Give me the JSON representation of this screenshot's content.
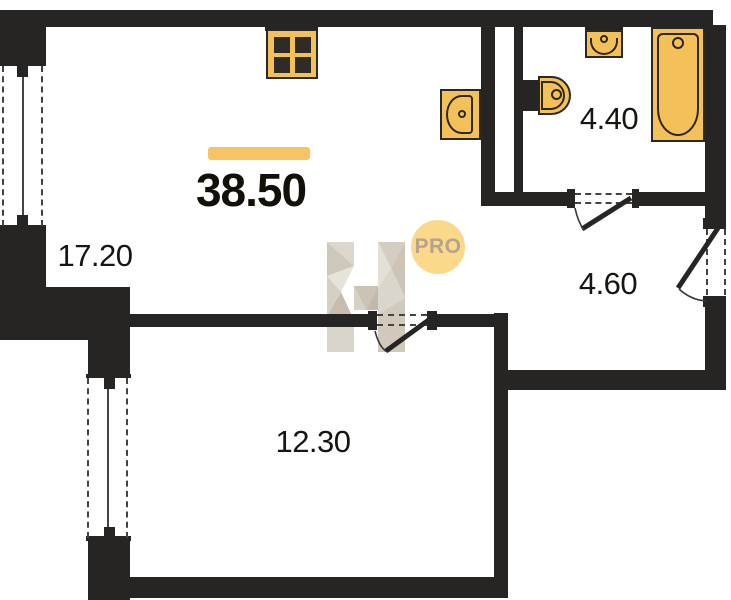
{
  "total": {
    "area": "38.50"
  },
  "rooms": {
    "living": {
      "area": "17.20"
    },
    "bedroom": {
      "area": "12.30"
    },
    "bathroom": {
      "area": "4.40"
    },
    "hallway": {
      "area": "4.60"
    }
  },
  "watermark": {
    "badge_text": "PRO",
    "logo": "H-logo"
  },
  "icons": {
    "stove": "stove-icon",
    "kitchen_sink": "sink-icon",
    "toilet": "toilet-icon",
    "washbasin": "washbasin-icon",
    "bathtub": "bathtub-icon"
  },
  "windows": [
    {
      "id": "living-room-window"
    },
    {
      "id": "bedroom-window"
    }
  ],
  "doors": [
    {
      "id": "bedroom-door"
    },
    {
      "id": "bathroom-door"
    },
    {
      "id": "entrance-door"
    }
  ],
  "colors": {
    "wall": "#272523",
    "fixture_fill": "#f3c158",
    "fixture_stroke": "#2b2722",
    "area_bar": "#f6c464",
    "badge_bg": "#fbd88a",
    "badge_text": "#b2a48e",
    "dashed_line": "#45423e",
    "label_ink": "#171511",
    "watermark_tones": [
      "#dad4ca",
      "#cbc3b6",
      "#e5e1d9",
      "#c2b9ab"
    ]
  }
}
